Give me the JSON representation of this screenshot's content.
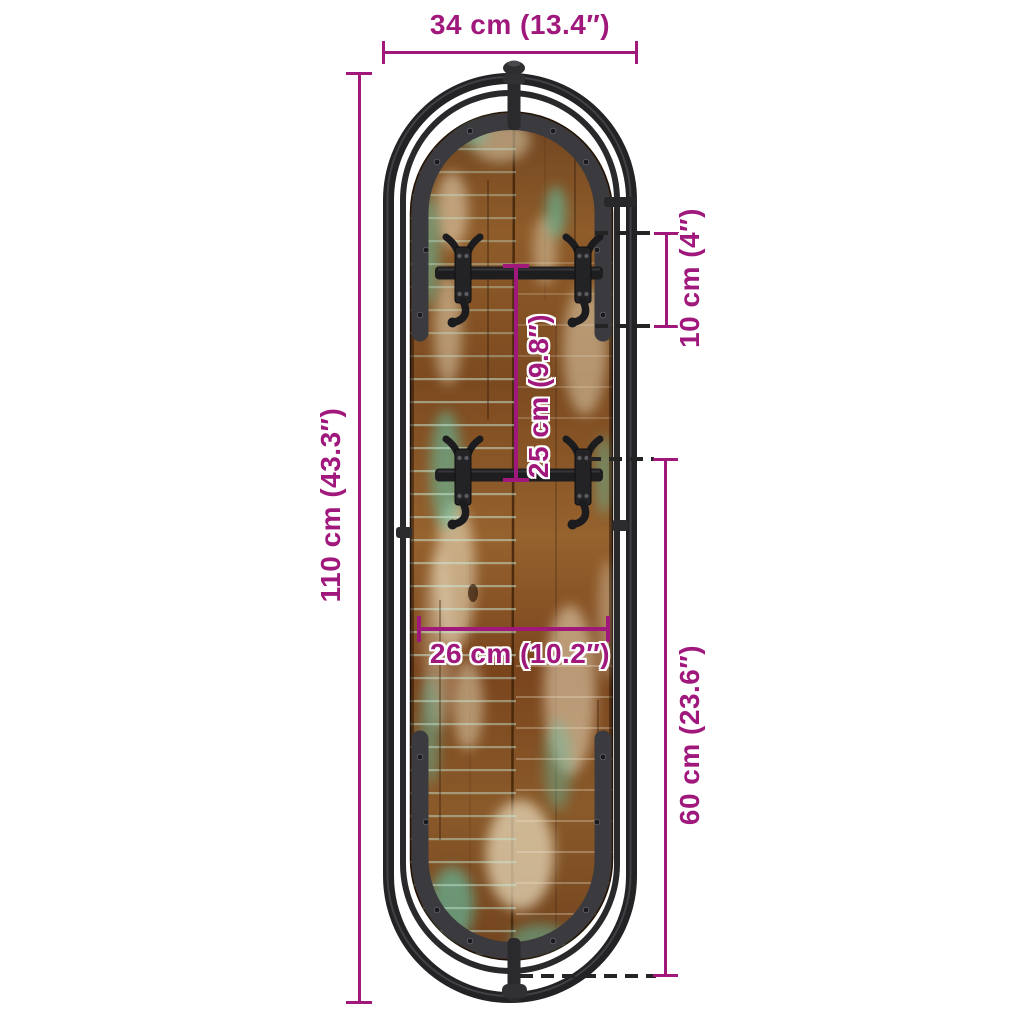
{
  "colors": {
    "dimension_magenta": "#a0187c",
    "dashed_guide": "#242424",
    "frame_dark": "#2a2a2c",
    "wood_brown": "#8a5626",
    "paint_teal": "#5fc6ac",
    "paint_cream": "#ecdfc0",
    "background": "#ffffff"
  },
  "annotations": {
    "width_overall": "34 cm (13.4″)",
    "height_overall": "110 cm (43.3″)",
    "hook_height": "10 cm (4″)",
    "hook_row_spacing": "25 cm (9.8″)",
    "board_width": "26 cm (10.2″)",
    "lower_section_height": "60 cm (23.6″)"
  }
}
